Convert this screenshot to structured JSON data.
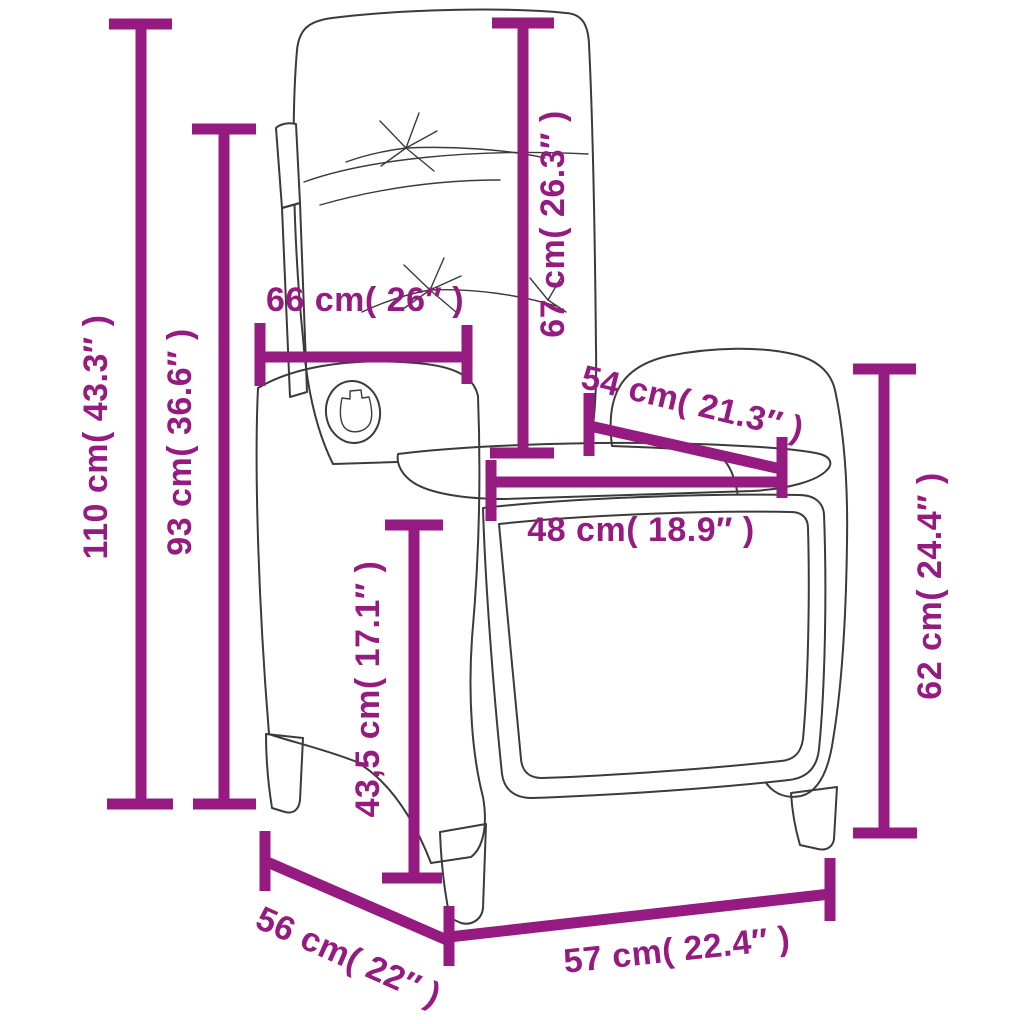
{
  "meta": {
    "description": "Dimension diagram of a reclining rattan garden chair with cushions",
    "accent_color": "#951b81",
    "outline_color": "#3b3b3b",
    "background_color": "#ffffff"
  },
  "dimensions": {
    "total_height": "110 cm( 43.3″ )",
    "backrest_height": "93 cm( 36.6″ )",
    "back_cushion_width": "66 cm( 26″ )",
    "back_cushion_height": "67 cm( 26.3″ )",
    "seat_diagonal": "54 cm( 21.3″ )",
    "seat_width": "48 cm( 18.9″ )",
    "seat_height": "43,5 cm( 17.1″ )",
    "armrest_height": "62 cm( 24.4″ )",
    "depth": "56 cm( 22″ )",
    "width": "57 cm( 22.4″ )"
  }
}
